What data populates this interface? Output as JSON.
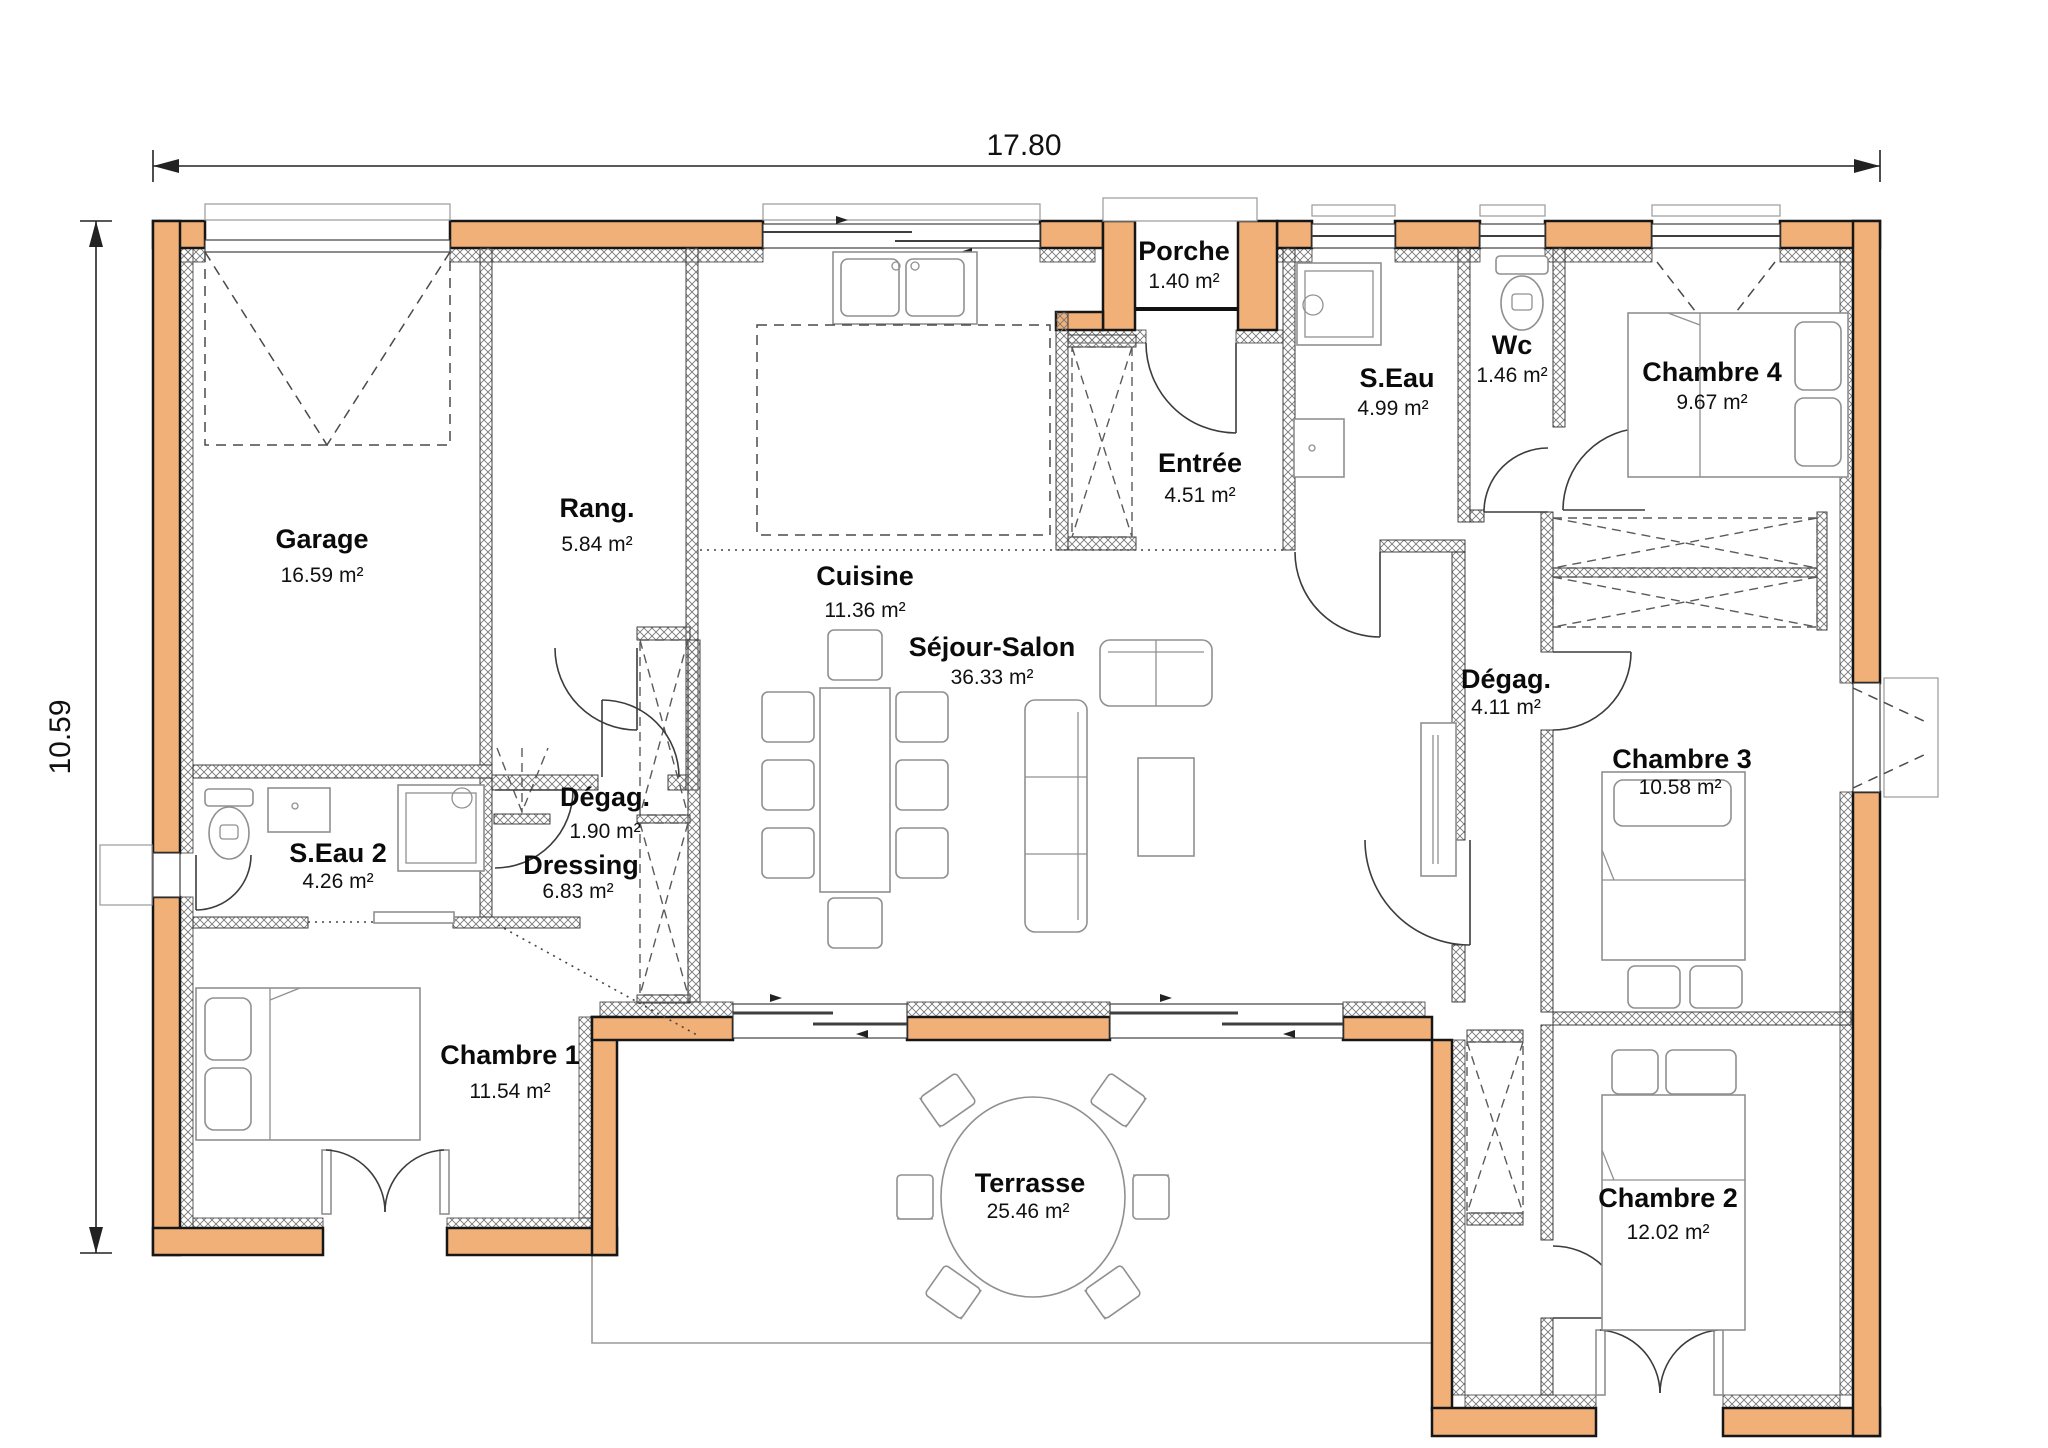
{
  "dimensions": {
    "width_label": "17.80",
    "height_label": "10.59"
  },
  "rooms": {
    "garage": {
      "name": "Garage",
      "area": "16.59 m²"
    },
    "rang": {
      "name": "Rang.",
      "area": "5.84 m²"
    },
    "cuisine": {
      "name": "Cuisine",
      "area": "11.36 m²"
    },
    "porche": {
      "name": "Porche",
      "area": "1.40 m²"
    },
    "entree": {
      "name": "Entrée",
      "area": "4.51 m²"
    },
    "seau": {
      "name": "S.Eau",
      "area": "4.99 m²"
    },
    "wc": {
      "name": "Wc",
      "area": "1.46 m²"
    },
    "chambre4": {
      "name": "Chambre 4",
      "area": "9.67 m²"
    },
    "sejour": {
      "name": "Séjour-Salon",
      "area": "36.33 m²"
    },
    "degag1": {
      "name": "Dégag.",
      "area": "1.90 m²"
    },
    "degag2": {
      "name": "Dégag.",
      "area": "4.11 m²"
    },
    "dressing": {
      "name": "Dressing",
      "area": "6.83 m²"
    },
    "seau2": {
      "name": "S.Eau 2",
      "area": "4.26 m²"
    },
    "chambre1": {
      "name": "Chambre 1",
      "area": "11.54 m²"
    },
    "chambre3": {
      "name": "Chambre 3",
      "area": "10.58 m²"
    },
    "chambre2": {
      "name": "Chambre 2",
      "area": "12.02 m²"
    },
    "terrasse": {
      "name": "Terrasse",
      "area": "25.46 m²"
    }
  },
  "icons": [
    "bed-icon",
    "toilet-icon",
    "shower-icon",
    "washbasin-icon",
    "kitchen-sink-icon",
    "dining-table-icon",
    "sofa-icon",
    "loveseat-icon",
    "coffee-table-icon",
    "terrace-table-icon",
    "wardrobe-icon",
    "garage-door-icon",
    "door-swing-icon",
    "sliding-bay-icon",
    "dimension-arrow-icon"
  ],
  "colors": {
    "wall_fill": "#F0B078",
    "wall_outline": "#161616",
    "hatch": "#777777",
    "furniture": "#909090",
    "dimension": "#222222",
    "background": "#ffffff"
  }
}
